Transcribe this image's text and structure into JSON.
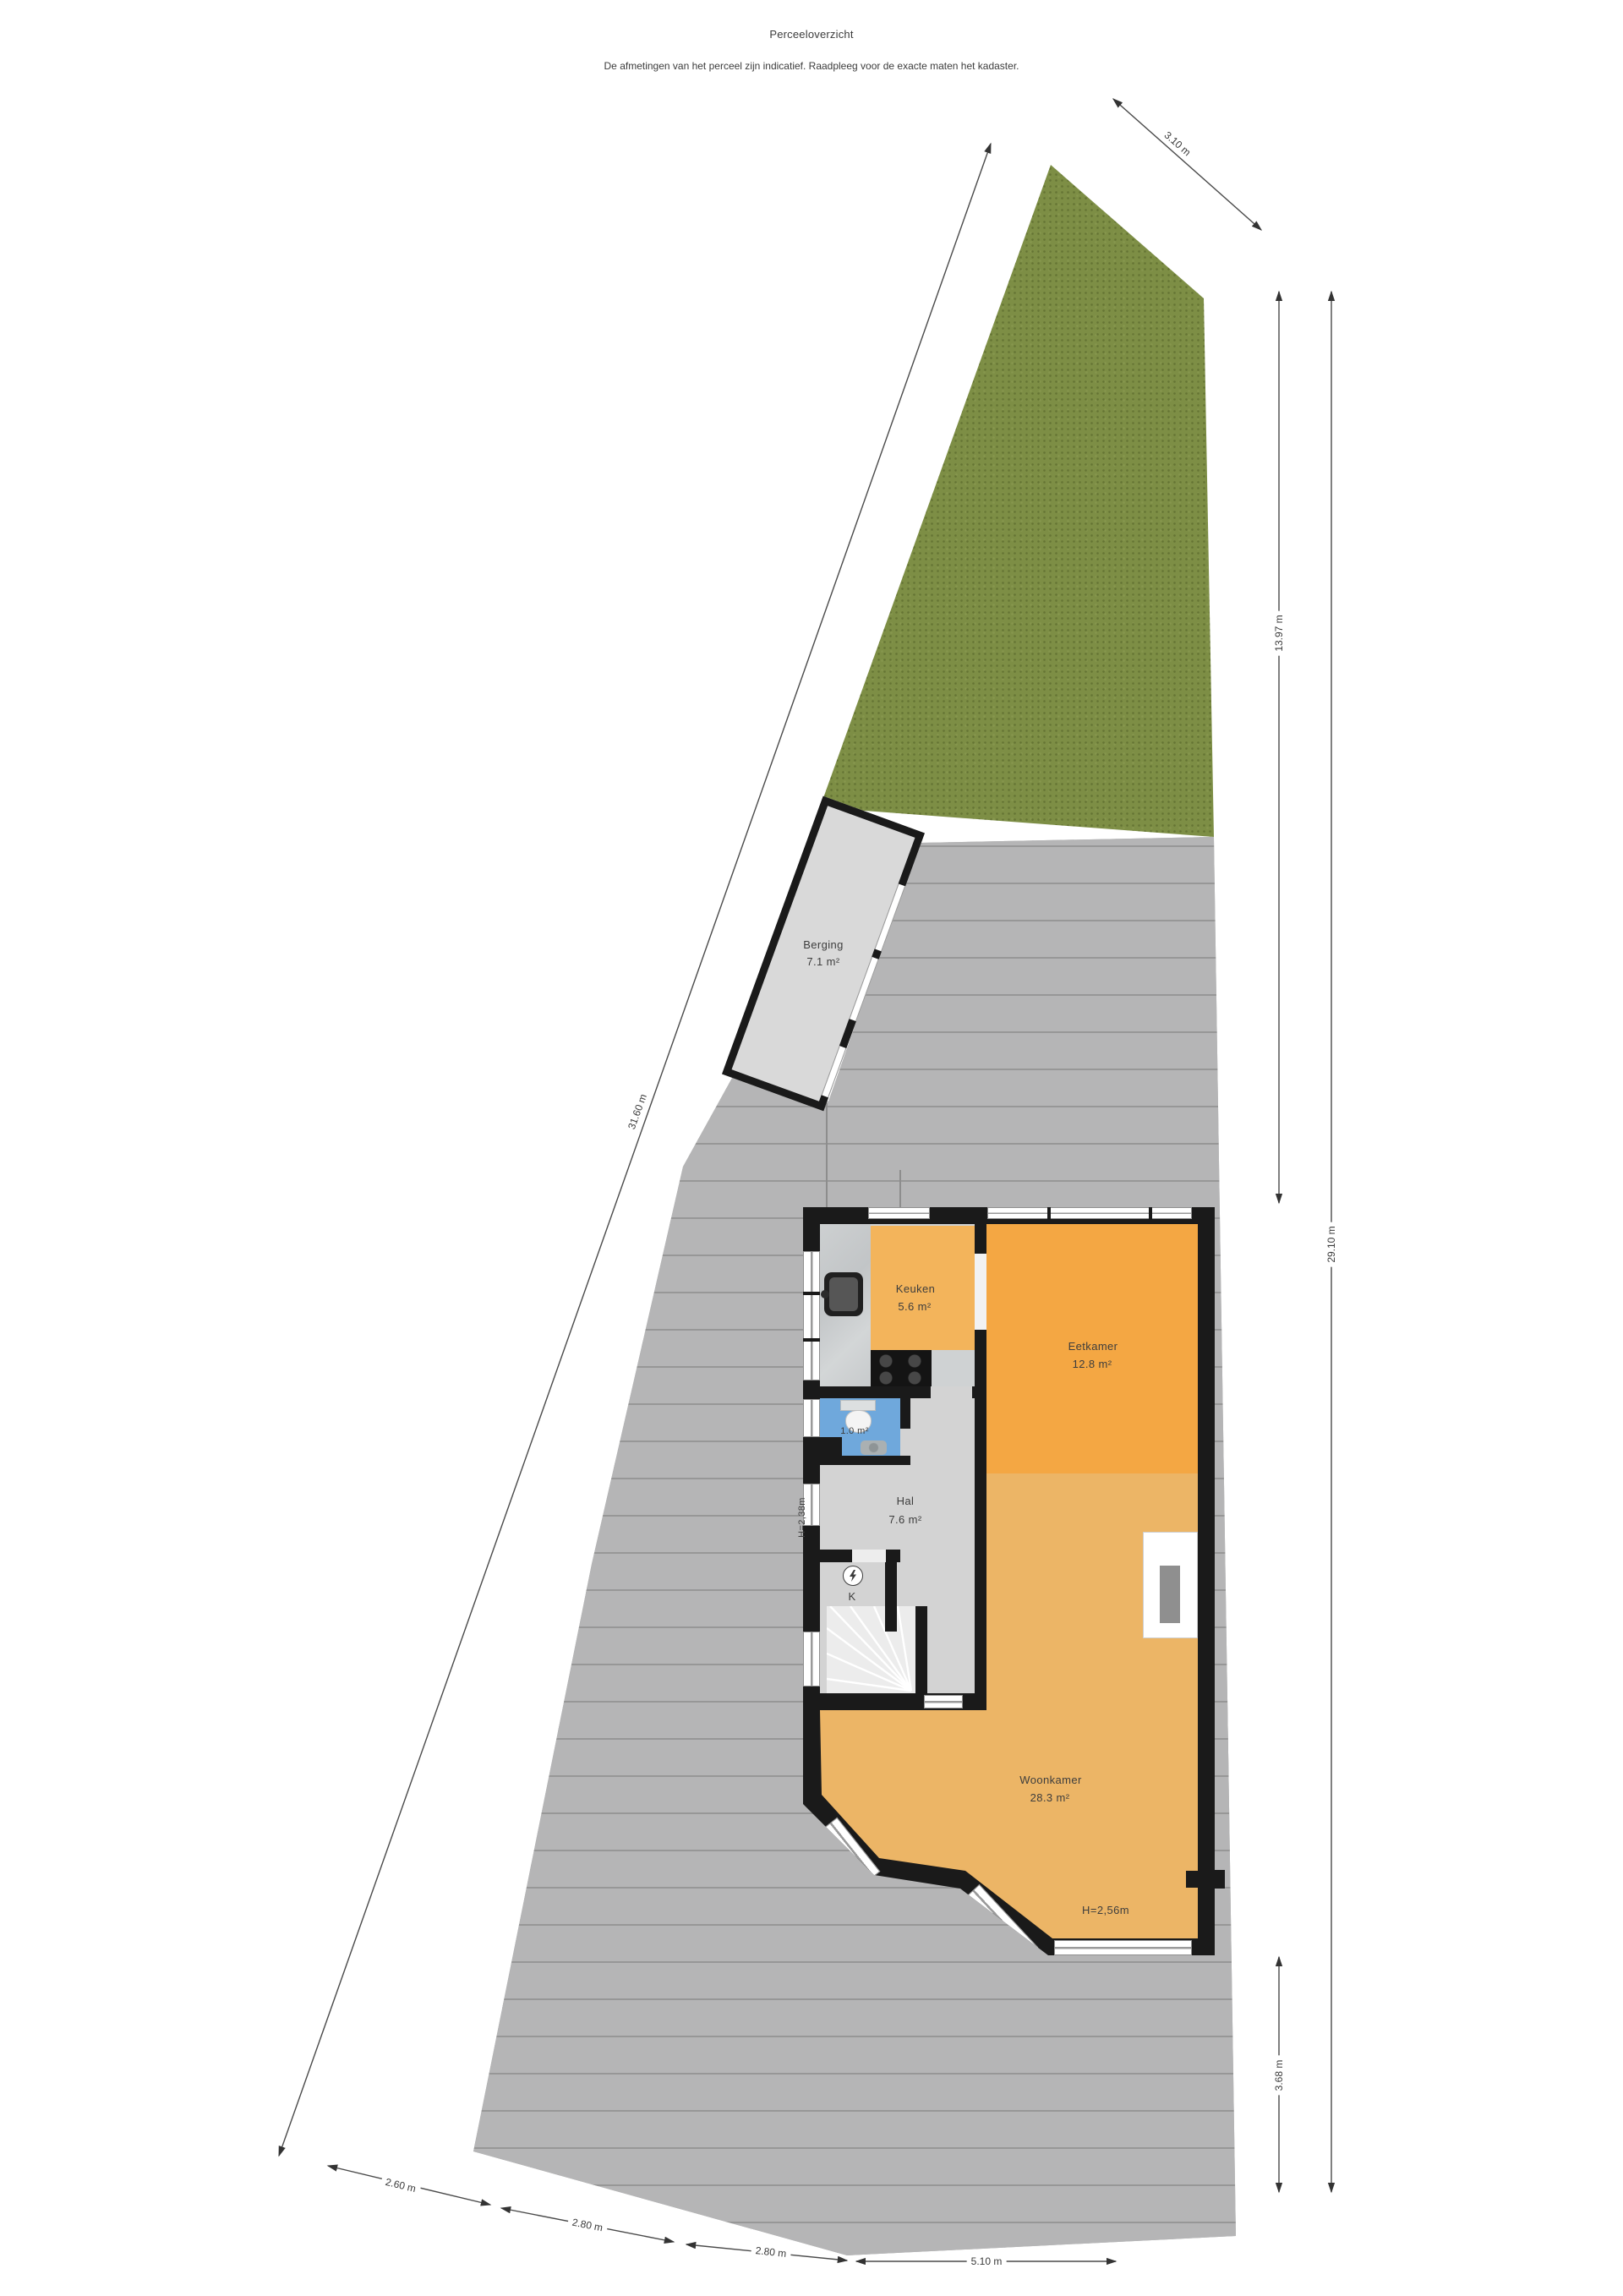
{
  "page": {
    "title": "Perceeloverzicht",
    "subtitle": "De afmetingen van het perceel zijn indicatief. Raadpleeg voor de exacte maten het kadaster."
  },
  "dimensions": {
    "top": "3.10 m",
    "left": "31.60 m",
    "right_upper": "13.97 m",
    "right_full": "29.10 m",
    "right_lower": "3.68 m",
    "bottom": [
      "2.60 m",
      "2.80 m",
      "2.80 m",
      "5.10 m"
    ]
  },
  "rooms": {
    "berging": {
      "name": "Berging",
      "area": "7.1 m²"
    },
    "keuken": {
      "name": "Keuken",
      "area": "5.6 m²"
    },
    "eetkamer": {
      "name": "Eetkamer",
      "area": "12.8 m²"
    },
    "toilet": {
      "area": "1.0 m²"
    },
    "hal": {
      "name": "Hal",
      "area": "7.6 m²"
    },
    "woonkamer": {
      "name": "Woonkamer",
      "area": "28.3 m²"
    },
    "meterkast": {
      "label": "K"
    }
  },
  "annotations": {
    "hal_height": "H=2,38m",
    "woonkamer_height": "H=2,56m"
  },
  "colors": {
    "grass": "#7d8e45",
    "paving": "#ababab",
    "wall": "#1a1a1a",
    "eetkamer": "#f4a743",
    "keuken": "#f3b45b",
    "woonkamer": "#ecb566",
    "hal": "#d3d3d3",
    "toilet": "#6fa8dc",
    "berging": "#d9d9d9",
    "stairs": "#ececec",
    "dimension_text": "#3a3a3a"
  }
}
